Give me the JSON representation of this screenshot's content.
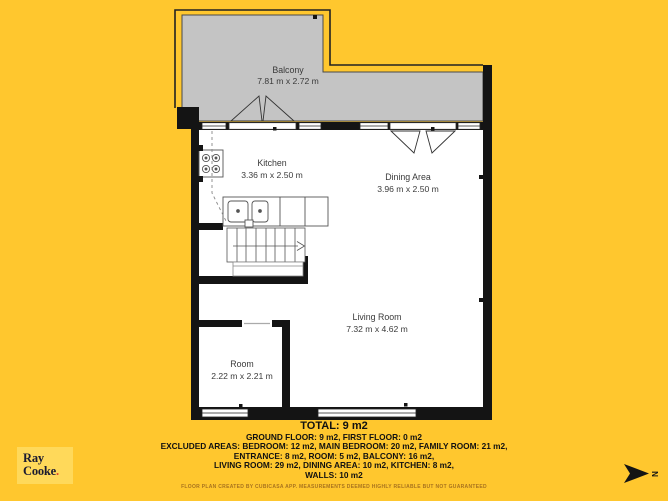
{
  "page": {
    "background_color": "#FFC72E"
  },
  "plan": {
    "wall_color": "#141414",
    "balcony_fill": "#C4C4C4",
    "floor_color": "#FFFFFF",
    "rooms": {
      "balcony": {
        "name": "Balcony",
        "dims": "7.81 m x 2.72 m"
      },
      "kitchen": {
        "name": "Kitchen",
        "dims": "3.36 m x 2.50 m"
      },
      "dining": {
        "name": "Dining Area",
        "dims": "3.96 m x 2.50 m"
      },
      "living": {
        "name": "Living Room",
        "dims": "7.32 m x 4.62 m"
      },
      "room": {
        "name": "Room",
        "dims": "2.22 m x 2.21 m"
      }
    }
  },
  "summary": {
    "total": "TOTAL: 9 m2",
    "lines": [
      "GROUND FLOOR: 9 m2, FIRST FLOOR: 0 m2",
      "EXCLUDED AREAS: BEDROOM: 12 m2, MAIN BEDROOM: 20 m2, FAMILY ROOM: 21 m2,",
      "ENTRANCE: 8 m2, ROOM: 5 m2, BALCONY: 16 m2,",
      "LIVING ROOM: 29 m2, DINING AREA: 10 m2, KITCHEN: 8 m2,",
      "WALLS: 10 m2"
    ]
  },
  "fine_print": "FLOOR PLAN CREATED BY CUBICASA APP. MEASUREMENTS DEEMED HIGHLY RELIABLE BUT NOT GUARANTEED",
  "logo": {
    "line1": "Ray",
    "line2": "Cooke",
    "dot": ".",
    "bg_color": "#FFD95A",
    "dot_color": "#E2452B"
  },
  "compass": {
    "label": "N"
  }
}
